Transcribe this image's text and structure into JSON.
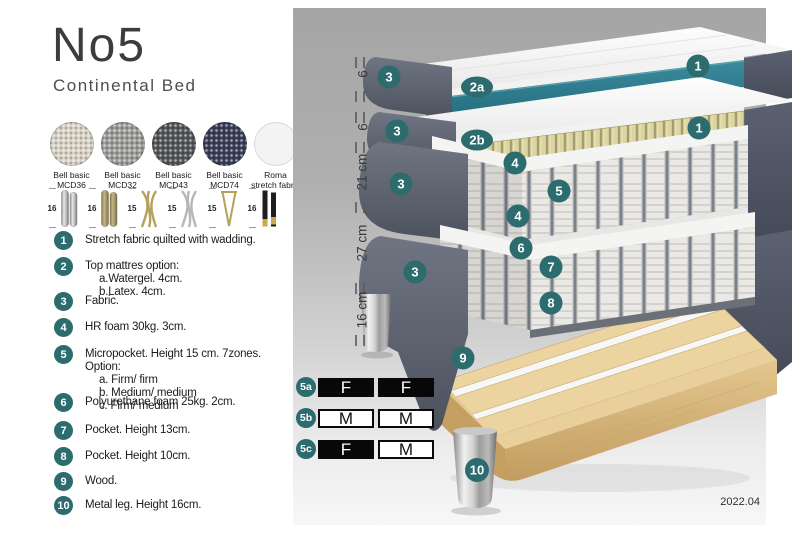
{
  "header": {
    "title": "No5",
    "subtitle": "Continental Bed"
  },
  "fabric": {
    "swatches": [
      {
        "name": "Bell basic",
        "code": "MCD36",
        "color": "#d8d2c6"
      },
      {
        "name": "Bell basic",
        "code": "MCD32",
        "color": "#9c9c9a"
      },
      {
        "name": "Bell basic",
        "code": "MCD43",
        "color": "#54575a"
      },
      {
        "name": "Bell basic",
        "code": "MCD74",
        "color": "#3a3f58"
      },
      {
        "name": "Roma",
        "code": "stretch fabric",
        "color": "#f3f3f3"
      }
    ]
  },
  "legs": {
    "options": [
      {
        "height": "16",
        "finish": "silver cylinder"
      },
      {
        "height": "16",
        "finish": "brass cylinder"
      },
      {
        "height": "15",
        "finish": "gold twist"
      },
      {
        "height": "15",
        "finish": "silver twist"
      },
      {
        "height": "15",
        "finish": "gold hairpin"
      },
      {
        "height": "16",
        "finish": "black with gold tip"
      }
    ]
  },
  "legend": {
    "items": [
      {
        "num": "1",
        "lines": [
          "Stretch fabric quilted with wadding."
        ]
      },
      {
        "num": "2",
        "lines": [
          "Top mattres option:",
          "a.Watergel. 4cm.",
          "b.Latex. 4cm."
        ]
      },
      {
        "num": "3",
        "lines": [
          "Fabric."
        ]
      },
      {
        "num": "4",
        "lines": [
          "HR foam 30kg. 3cm."
        ]
      },
      {
        "num": "5",
        "lines": [
          "Micropocket. Height 15 cm. 7zones. Option:",
          "a. Firm/ firm",
          "b. Medium/ medium",
          "c. Firm/ medium"
        ]
      },
      {
        "num": "6",
        "lines": [
          "Polyurethane foam 25kg. 2cm."
        ]
      },
      {
        "num": "7",
        "lines": [
          "Pocket. Height 13cm."
        ]
      },
      {
        "num": "8",
        "lines": [
          "Pocket. Height 10cm."
        ]
      },
      {
        "num": "9",
        "lines": [
          "Wood."
        ]
      },
      {
        "num": "10",
        "lines": [
          "Metal leg. Height 16cm."
        ]
      }
    ]
  },
  "diagram": {
    "measurements": [
      "6",
      "6",
      "21 cm",
      "27 cm",
      "16 cm"
    ],
    "callouts": [
      "1",
      "3",
      "2a",
      "1",
      "3",
      "2b",
      "4",
      "3",
      "5",
      "4",
      "6",
      "7",
      "3",
      "8",
      "9",
      "10"
    ],
    "firmness": {
      "rows": [
        {
          "label": "5a",
          "cells": [
            {
              "text": "F",
              "style": "dark"
            },
            {
              "text": "F",
              "style": "dark"
            }
          ]
        },
        {
          "label": "5b",
          "cells": [
            {
              "text": "M",
              "style": "light"
            },
            {
              "text": "M",
              "style": "light"
            }
          ]
        },
        {
          "label": "5c",
          "cells": [
            {
              "text": "F",
              "style": "dark"
            },
            {
              "text": "M",
              "style": "light"
            }
          ]
        }
      ]
    },
    "version": "2022.04"
  },
  "colors": {
    "badge_teal": "#2c6b6e",
    "topper_teal": "#2f8294",
    "fabric_gray": "#5d6370",
    "foam_yellow": "#ddd6a2",
    "wood": "#e9d09d",
    "panel_top": "#a6a6a6",
    "panel_bottom": "#f9f9f9"
  }
}
